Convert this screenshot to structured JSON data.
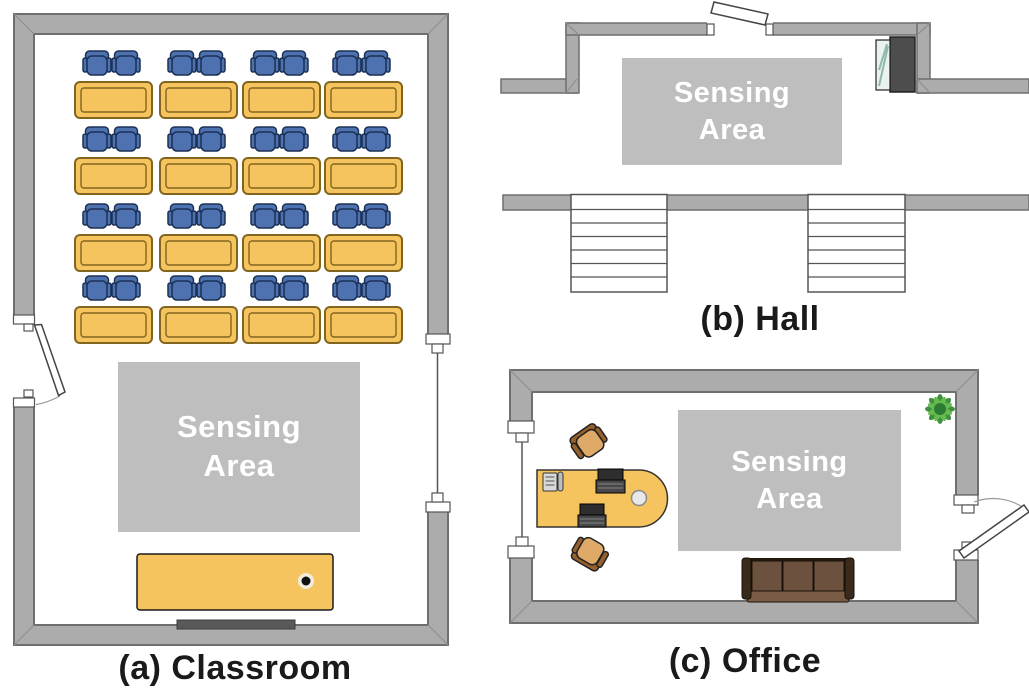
{
  "panels": {
    "classroom": {
      "caption": "(a) Classroom",
      "sensing_label": "Sensing Area"
    },
    "hall": {
      "caption": "(b) Hall",
      "sensing_label": "Sensing Area"
    },
    "office": {
      "caption": "(c) Office",
      "sensing_label": "Sensing Area"
    }
  },
  "colors": {
    "wall_fill": "#ACACAC",
    "wall_stroke": "#6F6F6F",
    "sensing_fill": "#BEBEBE",
    "sensing_text": "#FFFFFF",
    "desk_fill": "#F6C45E",
    "desk_stroke": "#82651E",
    "chair_blue": "#4E72B0",
    "chair_blue_stroke": "#1B3055",
    "office_chair_seat": "#DFA968",
    "office_chair_trim": "#96602C",
    "couch_frame": "#241A10",
    "couch_cushion": "#6C523E",
    "caption_text": "#1A1A1A"
  },
  "furniture": {
    "classroom": {
      "student_desks": 16,
      "student_chairs": 32,
      "teacher_desks": 1,
      "boards": 1,
      "doors": 1,
      "windows": 1
    },
    "hall": {
      "staircases": 2,
      "doors": 1,
      "vending_machines": 1
    },
    "office": {
      "desks": 1,
      "chairs": 2,
      "laptops": 2,
      "phones": 1,
      "couches": 1,
      "plants": 1,
      "doors": 1,
      "windows": 1
    }
  }
}
